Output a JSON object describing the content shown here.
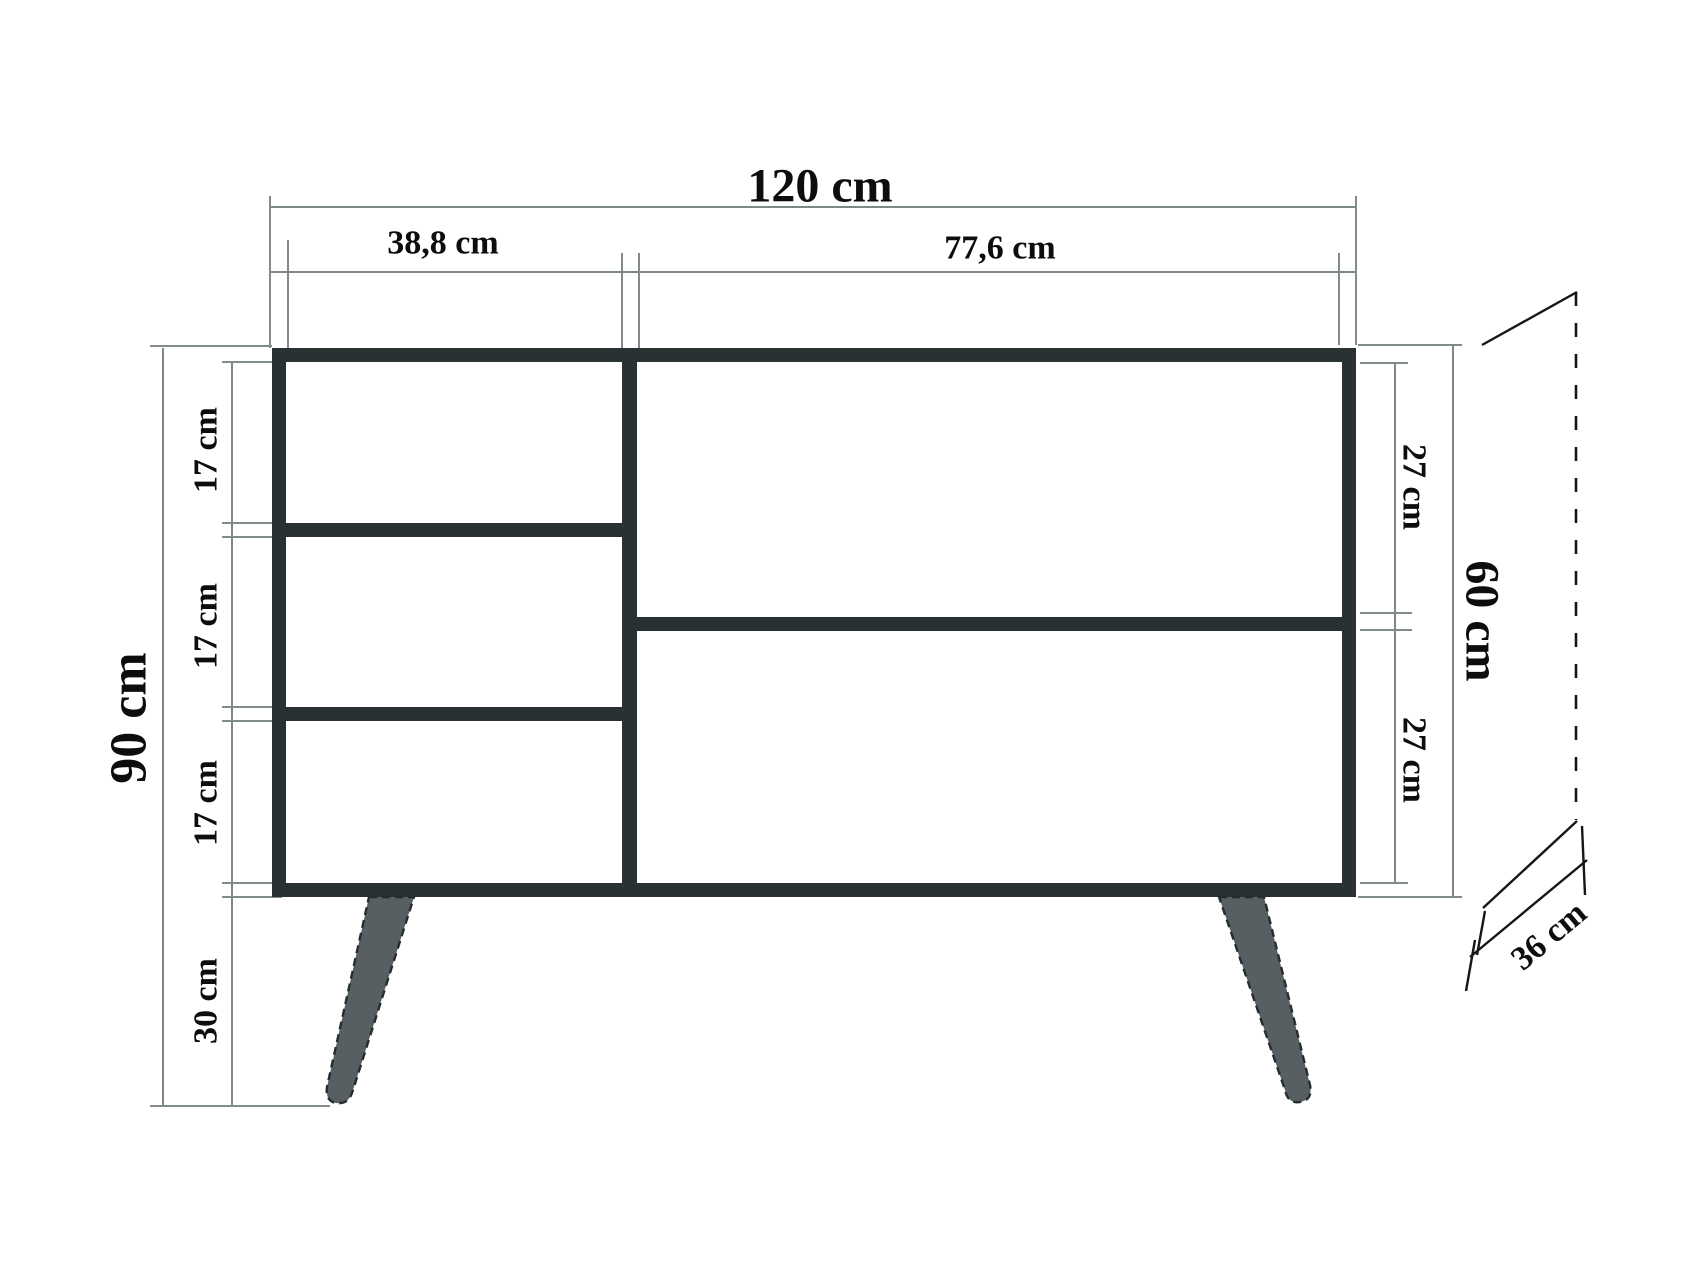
{
  "diagram": {
    "kind": "furniture-dimension-drawing",
    "subject": "sideboard front elevation with depth projection",
    "units": "cm",
    "labels": {
      "width_total": "120 cm",
      "width_left": "38,8 cm",
      "width_right": "77,6 cm",
      "height_total": "90 cm",
      "compartment_left_1": "17 cm",
      "compartment_left_2": "17 cm",
      "compartment_left_3": "17 cm",
      "leg_height": "30 cm",
      "compartment_right_1": "27 cm",
      "compartment_right_2": "27 cm",
      "height_body": "60 cm",
      "depth": "36 cm"
    },
    "values_cm": {
      "total_width": 120,
      "left_section_width": 38.8,
      "right_section_width": 77.6,
      "total_height": 90,
      "left_compartment_height": 17,
      "leg_height": 30,
      "right_compartment_height": 27,
      "body_height": 60,
      "depth": 36
    },
    "colors": {
      "cabinet_body": "#293133",
      "legs": "#575f62",
      "dimension_lines": "#7e888b",
      "projection_lines": "#161616",
      "text": "#0d0d0d",
      "background": "#ffffff"
    }
  }
}
